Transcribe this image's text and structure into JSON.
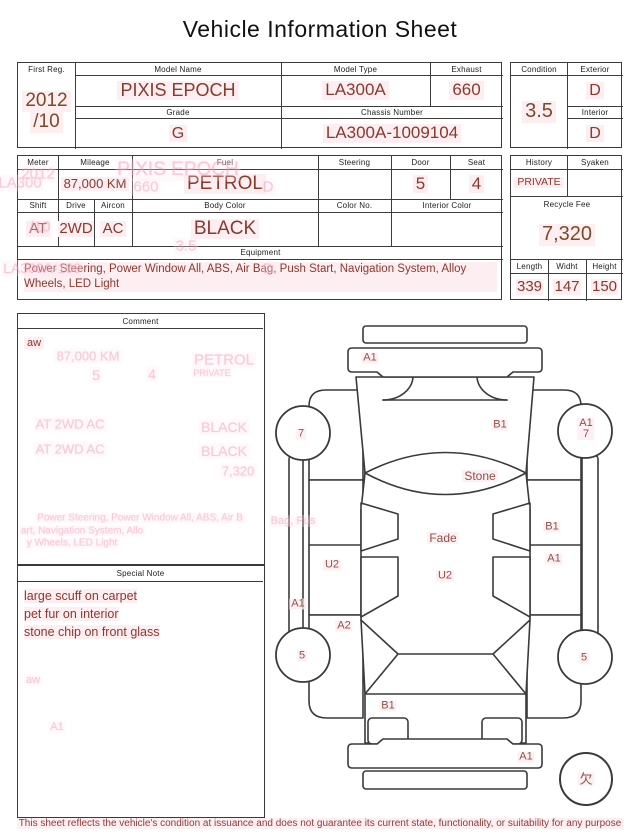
{
  "title": "Vehicle Information Sheet",
  "info_table": {
    "first_reg": {
      "label": "First Reg.",
      "line1": "2012",
      "line2": "/10"
    },
    "model_name": {
      "label": "Model Name",
      "value": "PIXIS EPOCH"
    },
    "model_type": {
      "label": "Model Type",
      "value": "LA300A"
    },
    "exhaust": {
      "label": "Exhaust",
      "value": "660"
    },
    "grade": {
      "label": "Grade",
      "value": "G"
    },
    "chassis_number": {
      "label": "Chassis Number",
      "value": "LA300A-1009104"
    },
    "condition": {
      "label": "Condition",
      "value": "3.5"
    },
    "exterior": {
      "label": "Exterior",
      "value": "D"
    },
    "interior": {
      "label": "Interior",
      "value": "D"
    }
  },
  "spec_table": {
    "meter": {
      "label": "Meter",
      "value": ""
    },
    "mileage": {
      "label": "Mileage",
      "value": "87,000 KM"
    },
    "fuel": {
      "label": "Fuel",
      "value": "PETROL"
    },
    "steering": {
      "label": "Steering",
      "value": ""
    },
    "door": {
      "label": "Door",
      "value": "5"
    },
    "seat": {
      "label": "Seat",
      "value": "4"
    },
    "shift": {
      "label": "Shift",
      "value": "AT"
    },
    "drive": {
      "label": "Drive",
      "value": "2WD"
    },
    "aircon": {
      "label": "Aircon",
      "value": "AC"
    },
    "body_color": {
      "label": "Body Color",
      "value": "BLACK"
    },
    "color_no": {
      "label": "Color No.",
      "value": ""
    },
    "interior_color": {
      "label": "Interior Color",
      "value": ""
    },
    "equipment": {
      "label": "Equipment",
      "value": "Power Steering, Power Window  All, ABS, Air Bag, Push Start, Navigation System, Alloy Wheels, LED Light"
    },
    "history": {
      "label": "History",
      "value": "PRIVATE"
    },
    "syaken": {
      "label": "Syaken",
      "value": ""
    },
    "recycle_fee": {
      "label": "Recycle Fee",
      "value": "7,320"
    },
    "length": {
      "label": "Length",
      "value": "339"
    },
    "width": {
      "label": "Widht",
      "value": "147"
    },
    "height": {
      "label": "Height",
      "value": "150"
    }
  },
  "comment": {
    "label": "Comment",
    "value": "aw"
  },
  "special_note": {
    "label": "Special Note",
    "value": "large scuff on carpet\npet fur on interior\nstone chip on front glass"
  },
  "diagram": {
    "labels": [
      {
        "text": "A1",
        "x": 100,
        "y": 48
      },
      {
        "text": "7",
        "x": 31,
        "y": 124
      },
      {
        "text": "A1\n7",
        "x": 316,
        "y": 119
      },
      {
        "text": "B1",
        "x": 230,
        "y": 115
      },
      {
        "text": "Stone",
        "x": 210,
        "y": 166,
        "size": 12
      },
      {
        "text": "Fade",
        "x": 173,
        "y": 228,
        "size": 12
      },
      {
        "text": "U2",
        "x": 175,
        "y": 266
      },
      {
        "text": "U2",
        "x": 62,
        "y": 255
      },
      {
        "text": "B1",
        "x": 282,
        "y": 217
      },
      {
        "text": "A1",
        "x": 284,
        "y": 249
      },
      {
        "text": "A1",
        "x": 28,
        "y": 294
      },
      {
        "text": "A2",
        "x": 74,
        "y": 316
      },
      {
        "text": "5",
        "x": 32,
        "y": 346
      },
      {
        "text": "5",
        "x": 314,
        "y": 348
      },
      {
        "text": "B1",
        "x": 118,
        "y": 396
      },
      {
        "text": "A1",
        "x": 256,
        "y": 447
      },
      {
        "text": "欠",
        "x": 316,
        "y": 469,
        "size": 13
      }
    ]
  },
  "ghosts": [
    {
      "text": "PIXIS EPOCH",
      "x": 178,
      "y": 170,
      "size": 19
    },
    {
      "text": "660",
      "x": 146,
      "y": 187,
      "size": 15
    },
    {
      "text": "D",
      "x": 268,
      "y": 187,
      "size": 15
    },
    {
      "text": "LA300",
      "x": 20,
      "y": 183,
      "size": 15
    },
    {
      "text": "2012",
      "x": 38,
      "y": 174,
      "size": 15
    },
    {
      "text": "/10",
      "x": 40,
      "y": 227,
      "size": 15
    },
    {
      "text": "3.5",
      "x": 186,
      "y": 246,
      "size": 15
    },
    {
      "text": "LA300A-100",
      "x": 42,
      "y": 268,
      "size": 14
    },
    {
      "text": "D",
      "x": 268,
      "y": 268,
      "size": 14
    },
    {
      "text": "87,000 KM",
      "x": 88,
      "y": 356,
      "size": 13
    },
    {
      "text": "PETROL",
      "x": 224,
      "y": 360,
      "size": 15
    },
    {
      "text": "5",
      "x": 96,
      "y": 375,
      "size": 14
    },
    {
      "text": "4",
      "x": 152,
      "y": 374,
      "size": 14
    },
    {
      "text": "PRIVATE",
      "x": 212,
      "y": 373,
      "size": 9
    },
    {
      "text": "AT  2WD  AC",
      "x": 70,
      "y": 424,
      "size": 13
    },
    {
      "text": "AT  2WD  AC",
      "x": 70,
      "y": 449,
      "size": 13
    },
    {
      "text": "BLACK",
      "x": 224,
      "y": 427,
      "size": 14
    },
    {
      "text": "BLACK",
      "x": 224,
      "y": 451,
      "size": 14
    },
    {
      "text": "7,320",
      "x": 238,
      "y": 471,
      "size": 13
    },
    {
      "text": "Power Steering, Power Window  All, ABS, Air B",
      "x": 140,
      "y": 518,
      "size": 10
    },
    {
      "text": "art, Navigation System, Allo",
      "x": 82,
      "y": 531,
      "size": 10
    },
    {
      "text": "y Wheels, LED Light",
      "x": 72,
      "y": 543,
      "size": 10
    },
    {
      "text": "Bag, Pus",
      "x": 293,
      "y": 521,
      "size": 11
    },
    {
      "text": "aw",
      "x": 33,
      "y": 680,
      "size": 11
    },
    {
      "text": "A1",
      "x": 57,
      "y": 727,
      "size": 11
    }
  ],
  "footer": "This sheet reflects the vehicle's condition at issuance and does not guarantee its current state, functionality, or suitability for any purpose"
}
